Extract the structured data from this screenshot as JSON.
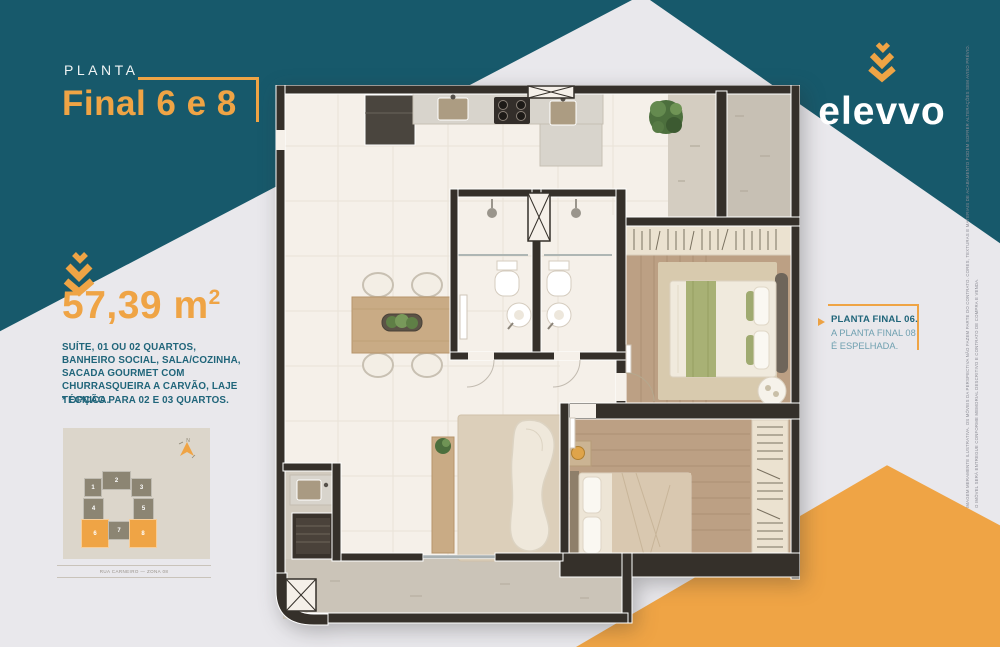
{
  "palette": {
    "teal": "#17596B",
    "orange": "#EFA445",
    "background": "#E9E8EC",
    "text_teal": "#20657A",
    "callout_muted": "#6FA0B0",
    "wall": "#35302A"
  },
  "header": {
    "eyebrow": "PLANTA",
    "title": "Final 6 e 8"
  },
  "brand": {
    "name": "elevvo",
    "icon": "triple-chevron-down"
  },
  "area": {
    "value": "57,39",
    "unit": " m",
    "exponent": "2"
  },
  "details": {
    "description": "SUÍTE, 01 OU 02 QUARTOS, BANHEIRO SOCIAL, SALA/COZINHA, SACADA GOURMET COM CHURRASQUEIRA A CARVÃO, LAJE TÉCNICA.",
    "option_note": "* OPÇÃO PARA 02 E 03 QUARTOS."
  },
  "keyplan": {
    "north_label": "N",
    "caption": "RUA CARNEIRO — ZONA 08",
    "units": [
      {
        "label": "1",
        "highlighted": false
      },
      {
        "label": "2",
        "highlighted": false
      },
      {
        "label": "3",
        "highlighted": false
      },
      {
        "label": "4",
        "highlighted": false
      },
      {
        "label": "5",
        "highlighted": false
      },
      {
        "label": "6",
        "highlighted": true
      },
      {
        "label": "7",
        "highlighted": false
      },
      {
        "label": "8",
        "highlighted": true
      }
    ]
  },
  "callout": {
    "heading": "PLANTA FINAL 06.",
    "line1": "A PLANTA FINAL 08",
    "line2": "É ESPELHADA."
  },
  "legal": {
    "vertical_disclaimer_line1": "IMAGEM MERAMENTE ILUSTRATIVA. OS MÓVEIS DA PERSPECTIVA NÃO FAZEM PARTE DO CONTRATO. CORES, TEXTURAS E MATERIAIS DE ACABAMENTO PODEM SOFRER ALTERAÇÕES SEM AVISO PRÉVIO.",
    "vertical_disclaimer_line2": "O IMÓVEL SERÁ ENTREGUE CONFORME MEMORIAL DESCRITIVO E CONTRATO DE COMPRA E VENDA."
  },
  "floorplan": {
    "alt": "Planta humanizada do apartamento — final 6 e 8"
  }
}
